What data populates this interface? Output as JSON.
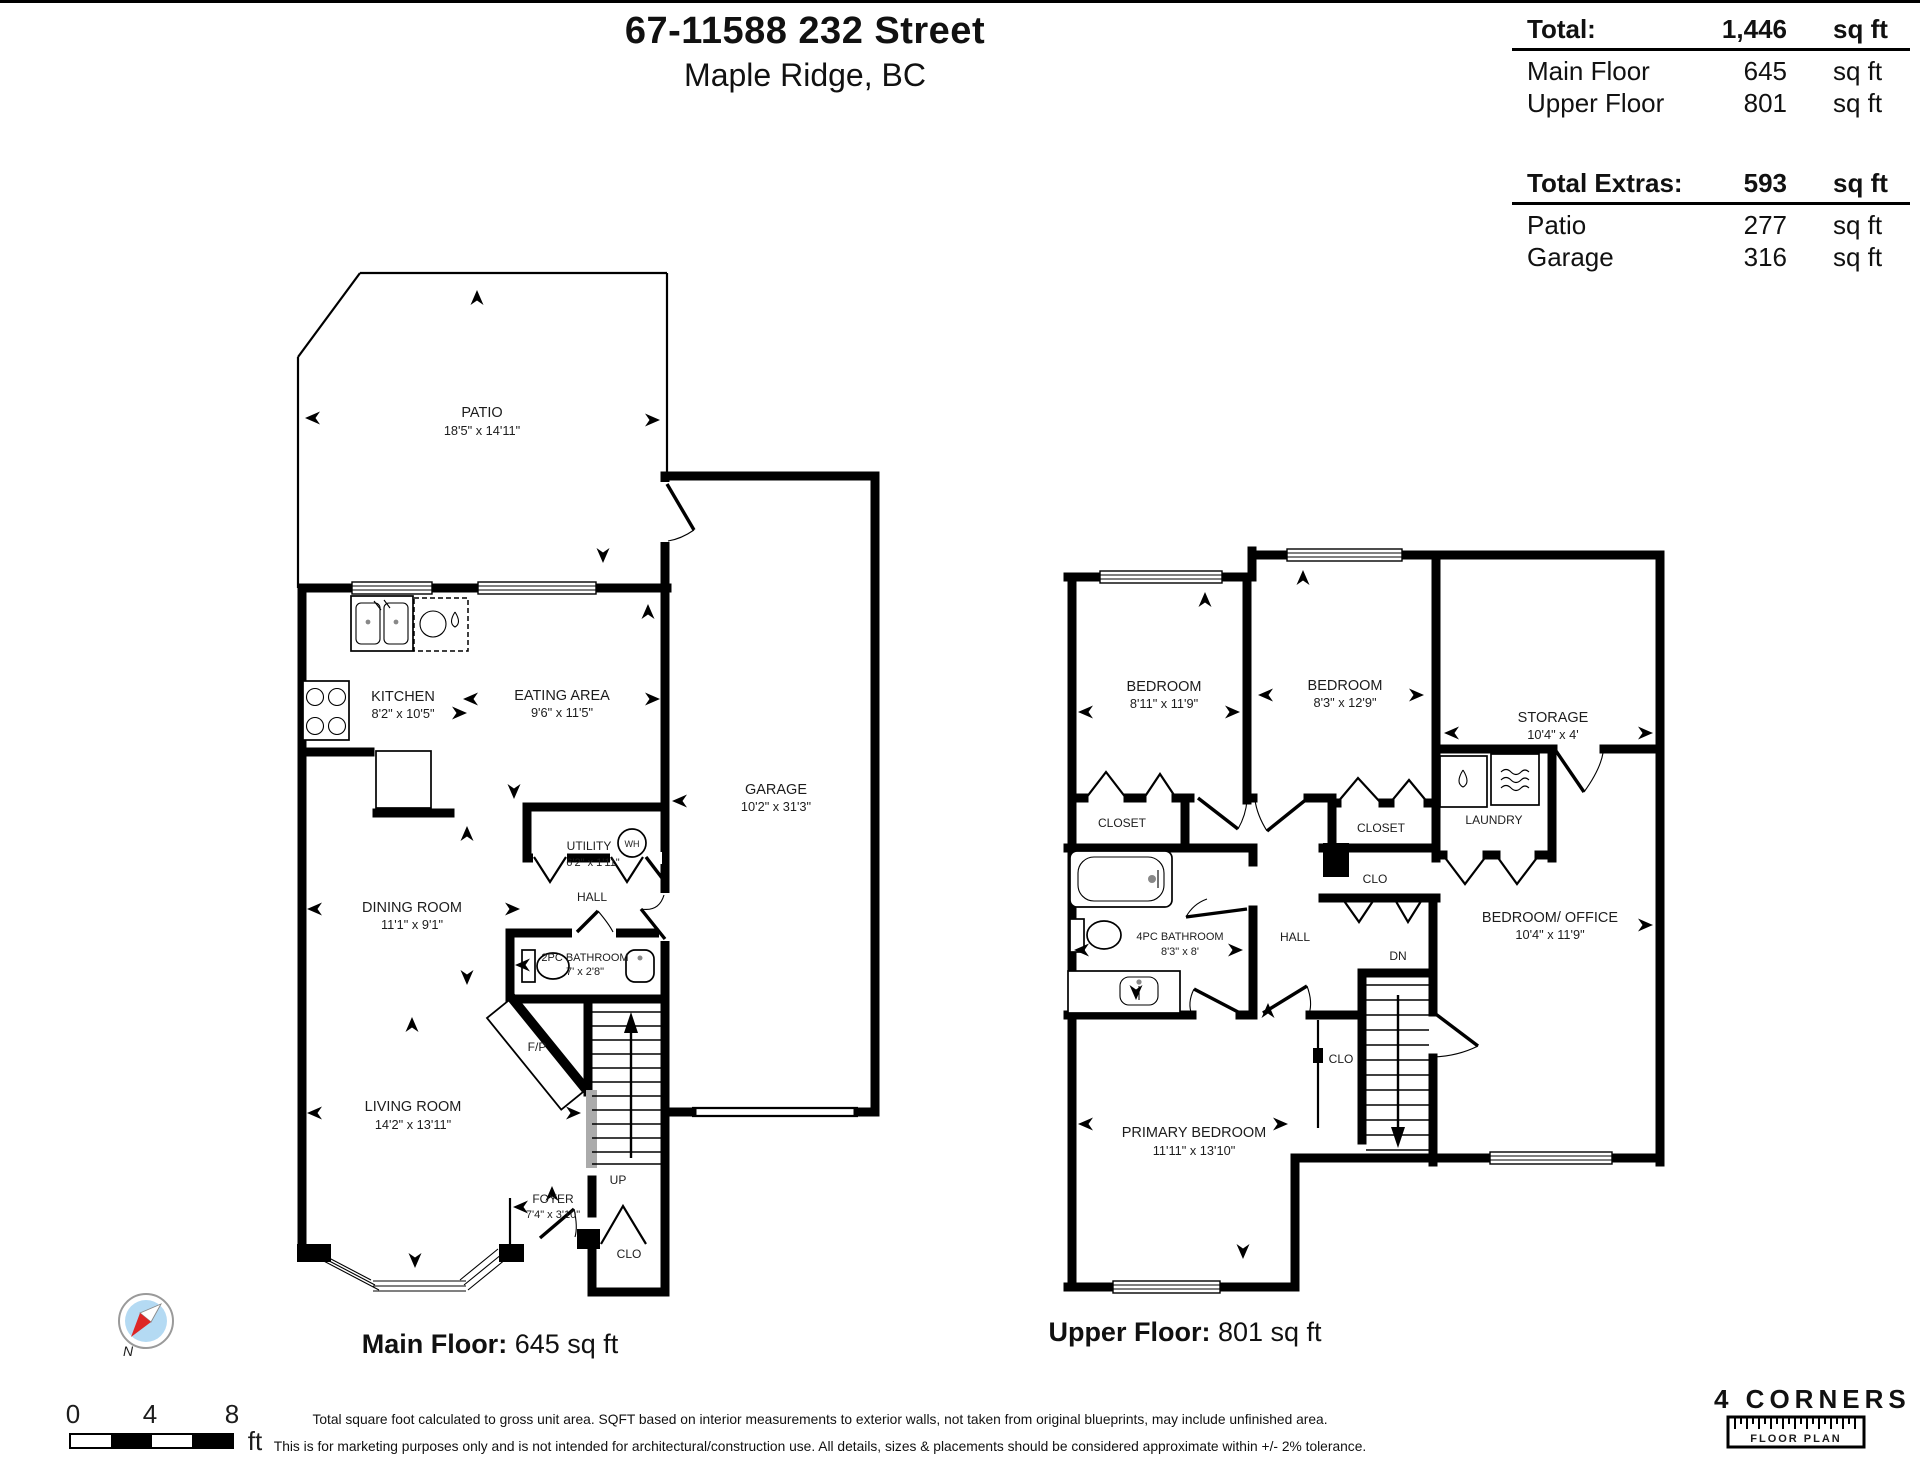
{
  "header": {
    "title": "67-11588 232 Street",
    "subtitle": "Maple Ridge, BC"
  },
  "summary": {
    "total": {
      "label": "Total:",
      "value": "1,446",
      "unit": "sq ft"
    },
    "main_floor": {
      "label": "Main Floor",
      "value": "645",
      "unit": "sq ft"
    },
    "upper_floor": {
      "label": "Upper Floor",
      "value": "801",
      "unit": "sq ft"
    },
    "extras_total": {
      "label": "Total Extras:",
      "value": "593",
      "unit": "sq ft"
    },
    "patio": {
      "label": "Patio",
      "value": "277",
      "unit": "sq ft"
    },
    "garage": {
      "label": "Garage",
      "value": "316",
      "unit": "sq ft"
    }
  },
  "main_floor": {
    "caption_label": "Main Floor:",
    "caption_value": "645 sq ft",
    "rooms": [
      {
        "name": "PATIO",
        "dims": "18'5\" x 14'11\""
      },
      {
        "name": "KITCHEN",
        "dims": "8'2\" x 10'5\""
      },
      {
        "name": "EATING AREA",
        "dims": "9'6\" x 11'5\""
      },
      {
        "name": "GARAGE",
        "dims": "10'2\" x 31'3\""
      },
      {
        "name": "UTILITY",
        "dims": "6'2\" x 1'11\""
      },
      {
        "name": "DINING ROOM",
        "dims": "11'1\" x 9'1\""
      },
      {
        "name": "2PC BATHROOM",
        "dims": "7' x 2'8\""
      },
      {
        "name": "LIVING ROOM",
        "dims": "14'2\" x 13'11\""
      },
      {
        "name": "FOYER",
        "dims": "7'4\" x 3'10\""
      }
    ],
    "features": {
      "hall": "HALL",
      "up": "UP",
      "clo": "CLO",
      "fp": "F/P",
      "wh": "WH"
    }
  },
  "upper_floor": {
    "caption_label": "Upper Floor:",
    "caption_value": "801 sq ft",
    "rooms": [
      {
        "name": "BEDROOM",
        "dims": "8'11\" x 11'9\""
      },
      {
        "name": "BEDROOM",
        "dims": "8'3\" x 12'9\""
      },
      {
        "name": "STORAGE",
        "dims": "10'4\" x 4'"
      },
      {
        "name": "4PC BATHROOM",
        "dims": "8'3\" x 8'"
      },
      {
        "name": "BEDROOM/ OFFICE",
        "dims": "10'4\" x 11'9\""
      },
      {
        "name": "PRIMARY BEDROOM",
        "dims": "11'11\" x 13'10\""
      }
    ],
    "features": {
      "closet_a": "CLOSET",
      "closet_b": "CLOSET",
      "laundry": "LAUNDRY",
      "clo_a": "CLO",
      "clo_b": "CLO",
      "hall": "HALL",
      "dn": "DN"
    }
  },
  "compass": {
    "north_label": "N"
  },
  "scale_bar": {
    "tick0": "0",
    "tick1": "4",
    "tick2": "8",
    "unit": "ft"
  },
  "disclaimer": {
    "line1": "Total square foot calculated to gross unit area. SQFT based on interior measurements to exterior walls, not taken from original blueprints, may include unfinished area.",
    "line2": "This is for marketing purposes only and is not intended for architectural/construction use.  All details, sizes & placements should be considered approximate within +/- 2%  tolerance."
  },
  "logo": {
    "name": "4 CORNERS",
    "sub": "FLOOR PLAN"
  }
}
